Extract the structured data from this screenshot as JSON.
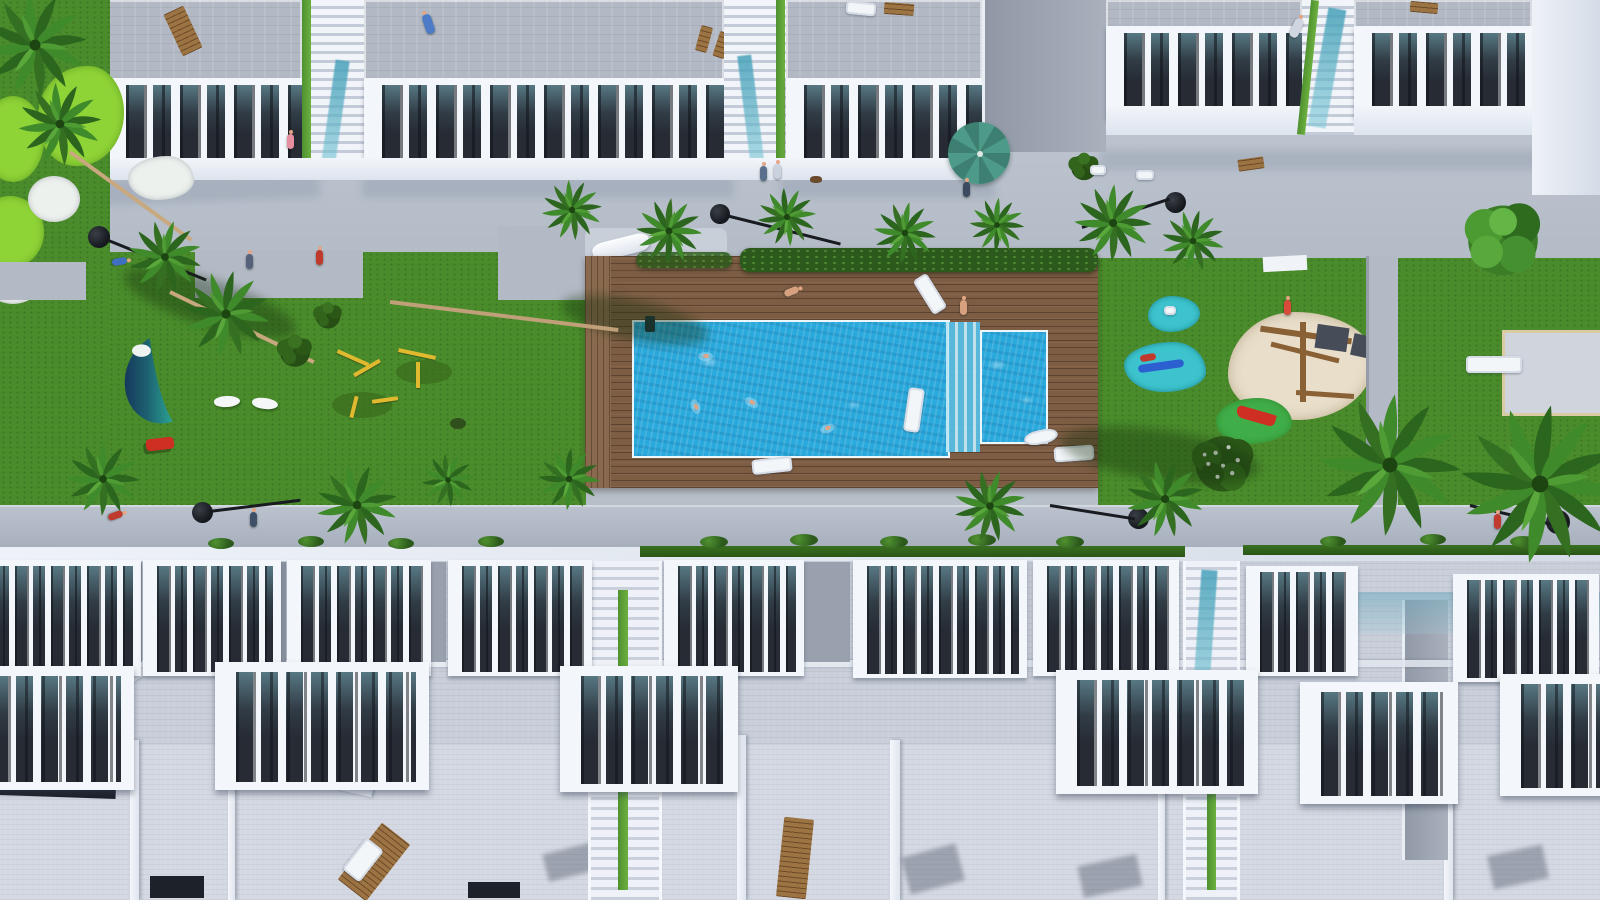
{
  "meta": {
    "type": "architectural-aerial-render",
    "description": "Top-down 3D render of a white residential complex: upper apartment row with roof terraces and balustraded balconies, central garden with wooden pool deck, large and small swimming pools, lawns with golf greens, pond, playground with sand pit and splash pads, palm-lined walkways, and lower rows of townhouses with rooftop terraces."
  },
  "palette": {
    "plaza": "#b7bfc9",
    "path": "#b3bac6",
    "grass": "#4a8c2b",
    "putting": "#8fd437",
    "roof": "#b2b9c5",
    "bw": "#f3f6fa",
    "pool": "#2aa9dc",
    "deck": "#7d5d44",
    "hedge": "#2c5a1c",
    "splash": "#3cc3cd",
    "sand": "#e8deca",
    "umbrella": "#4e9a88",
    "accent_red": "#c03a2e",
    "gym_yellow": "#e0b92f",
    "pond_navy": "#1c4f70",
    "pond_teal": "#2ba393"
  },
  "labels": {
    "scene": "Aerial render of residential complex",
    "top_row": "Upper apartment buildings with roof terraces",
    "garden": "Central landscaped garden",
    "main_pool": "Main swimming pool",
    "kids_pool": "Small square pool",
    "deck": "Wooden pool deck",
    "pond": "Ornamental pond",
    "playground": "Sand playground",
    "splash_pads": "Teal splash pads",
    "gym": "Outdoor gym equipment",
    "sidewalk": "Palm-lined promenade",
    "bottom_row": "Townhouse rows with balconies and rooftops",
    "golf": "Putting greens with bunkers",
    "court_pad": "Concrete pad with bench"
  },
  "counts": {
    "palms": 18,
    "swimmers": 4,
    "sun_loungers": 9,
    "street_lamps": 6,
    "balcony_units_visible": 24
  }
}
